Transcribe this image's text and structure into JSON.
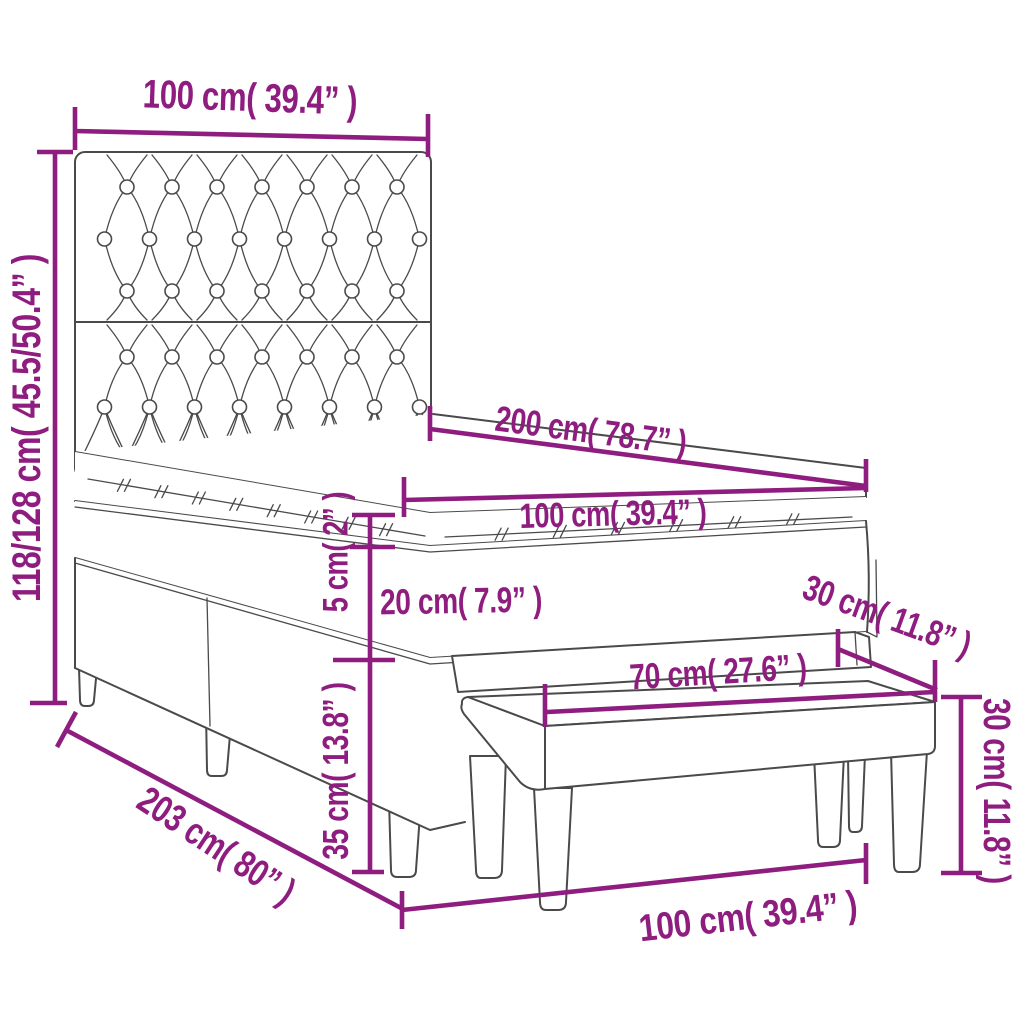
{
  "diagram": {
    "accent_color": "#8e1d7f",
    "line_color": "#4a4a4a",
    "labels": {
      "headboard_width": "100 cm( 39.4” )",
      "total_height": "118/128 cm( 45.5/50.4” )",
      "bed_length": "200 cm( 78.7” )",
      "mattress_width": "100 cm( 39.4” )",
      "topper_thickness": "5 cm( 2” )",
      "mattress_thickness": "20 cm( 7.9” )",
      "bench_depth": "30 cm( 11.8” )",
      "bench_length": "70 cm( 27.6” )",
      "bench_height": "30 cm( 11.8” )",
      "base_height": "35 cm( 13.8” )",
      "base_length": "203 cm( 80” )",
      "bench_width": "100 cm( 39.4” )"
    }
  }
}
